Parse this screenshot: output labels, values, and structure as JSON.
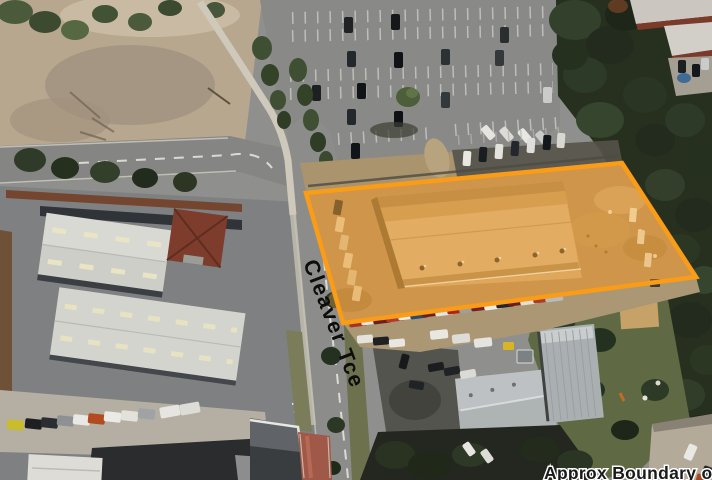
{
  "map": {
    "street_label": "Cleaver Tce",
    "disclaimer": "Approx Boundary only"
  },
  "boundary": {
    "color": "#F99C18",
    "fill_opacity": "0.32",
    "stroke_width": "4.5"
  },
  "labels": {
    "street_color": "#0D0D0D",
    "disclaimer_color": "#1A1A1A",
    "disclaimer_halo": "#FFFFFF"
  }
}
